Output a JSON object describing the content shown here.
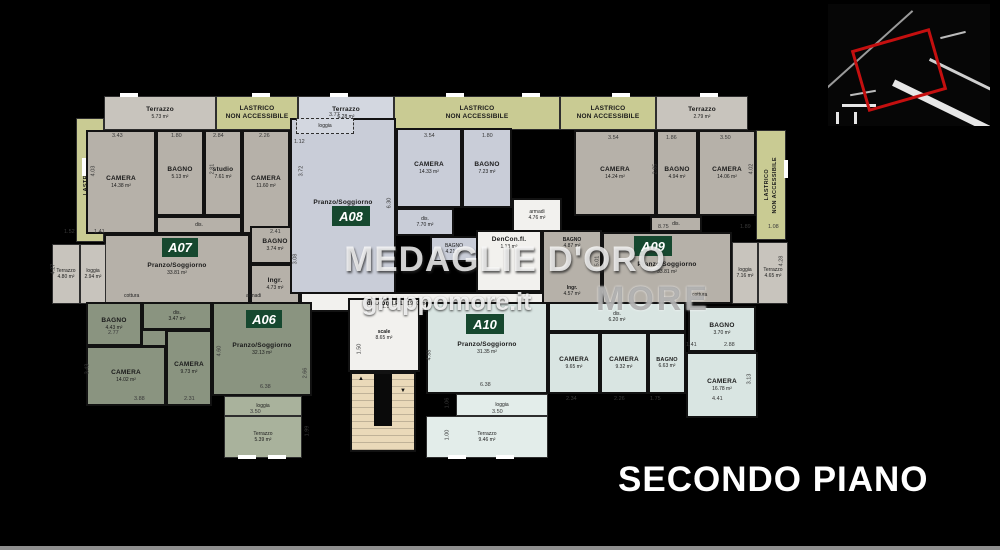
{
  "page": {
    "floor_title": "SECONDO PIANO"
  },
  "watermark": {
    "brand": "MEDAGLIE D'ORO",
    "site": "gruppomore.it",
    "logo": "MORE"
  },
  "legend": {
    "lastrico_line1": "LASTRICO",
    "lastrico_line2": "NON ACCESSIBILE"
  },
  "annotations": {
    "cottura": "cottura",
    "armadi": "armadi"
  },
  "common_areas": {
    "stairs": {
      "name": "scale",
      "area": "8.65 m²"
    },
    "landing": {
      "name": "dis.cond.P1",
      "area": "19.93 m²"
    },
    "wardrobe": {
      "name": "armadi",
      "area": "4.76 m²"
    },
    "den": {
      "name": "DenCon.fl.",
      "area": "1.13 m²"
    }
  },
  "apartments": {
    "a06": {
      "id": "A06",
      "rooms": {
        "bagno": {
          "name": "BAGNO",
          "area": "4.43 m²"
        },
        "dis": {
          "name": "dis.",
          "area": "3.47 m²"
        },
        "camera1": {
          "name": "CAMERA",
          "area": "14.02 m²"
        },
        "camera2": {
          "name": "CAMERA",
          "area": "9.73 m²"
        },
        "soggiorno": {
          "name": "Pranzo/Soggiorno",
          "area": "32.13 m²"
        },
        "loggia": {
          "name": "loggia",
          "area": "3.55 m²"
        },
        "terrazzo": {
          "name": "Terrazzo",
          "area": "5.39 m²"
        }
      }
    },
    "a07": {
      "id": "A07",
      "rooms": {
        "terrazzo_top": {
          "name": "Terrazzo",
          "area": "5.73 m²"
        },
        "camera1": {
          "name": "CAMERA",
          "area": "14.38 m²"
        },
        "bagno1": {
          "name": "BAGNO",
          "area": "5.13 m²"
        },
        "studio": {
          "name": "studio",
          "area": "7.61 m²"
        },
        "camera2": {
          "name": "CAMERA",
          "area": "11.60 m²"
        },
        "dis": {
          "name": "dis.",
          "area": "5.70 m²"
        },
        "soggiorno": {
          "name": "Pranzo/Soggiorno",
          "area": "33.81 m²"
        },
        "bagno2": {
          "name": "BAGNO",
          "area": "3.74 m²"
        },
        "ingresso": {
          "name": "Ingr.",
          "area": "4.73 m²"
        },
        "terrazzo": {
          "name": "Terrazzo",
          "area": "4.80 m²"
        },
        "loggia": {
          "name": "loggia",
          "area": "2.94 m²"
        }
      }
    },
    "a08": {
      "id": "A08",
      "rooms": {
        "terrazzo_top": {
          "name": "Terrazzo",
          "area": "6.28 m²"
        },
        "loggia": {
          "name": "loggia",
          "area": "4.90 m²"
        },
        "soggiorno": {
          "name": "Pranzo/Soggiorno",
          "area": "35.64 m²"
        },
        "camera": {
          "name": "CAMERA",
          "area": "14.33 m²"
        },
        "bagno1": {
          "name": "BAGNO",
          "area": "7.23 m²"
        },
        "dis": {
          "name": "dis.",
          "area": "7.70 m²"
        },
        "bagno2": {
          "name": "BAGNO",
          "area": "4.21 m²"
        }
      }
    },
    "a09": {
      "id": "A09",
      "rooms": {
        "terrazzo_top": {
          "name": "Terrazzo",
          "area": "2.79 m²"
        },
        "camera1": {
          "name": "CAMERA",
          "area": "14.24 m²"
        },
        "bagno1": {
          "name": "BAGNO",
          "area": "4.94 m²"
        },
        "camera2": {
          "name": "CAMERA",
          "area": "14.06 m²"
        },
        "dis": {
          "name": "dis.",
          "area": "2.43 m²"
        },
        "bagno2": {
          "name": "BAGNO",
          "area": "4.87 m²"
        },
        "ingresso": {
          "name": "Ingr.",
          "area": "4.57 m²"
        },
        "soggiorno": {
          "name": "Pranzo/Soggiorno",
          "area": "33.81 m²"
        },
        "loggia": {
          "name": "loggia",
          "area": "7.16 m²"
        },
        "terrazzo": {
          "name": "Terrazzo",
          "area": "4.65 m²"
        }
      }
    },
    "a10": {
      "id": "A10",
      "rooms": {
        "soggiorno": {
          "name": "Pranzo/Soggiorno",
          "area": "31.35 m²"
        },
        "dis": {
          "name": "dis.",
          "area": "6.20 m²"
        },
        "camera1": {
          "name": "CAMERA",
          "area": "9.65 m²"
        },
        "camera2": {
          "name": "CAMERA",
          "area": "9.32 m²"
        },
        "bagno1": {
          "name": "BAGNO",
          "area": "6.63 m²"
        },
        "bagno2": {
          "name": "BAGNO",
          "area": "3.70 m²"
        },
        "camera3": {
          "name": "CAMERA",
          "area": "16.78 m²"
        },
        "loggia": {
          "name": "loggia",
          "area": "3.57 m²"
        },
        "terrazzo": {
          "name": "Terrazzo",
          "area": "9.46 m²"
        }
      }
    }
  },
  "dims": [
    "3.43",
    "1.80",
    "2.84",
    "2.26",
    "4.03",
    "2.81",
    "1.12",
    "3.77",
    "3.72",
    "3.54",
    "1.80",
    "3.54",
    "1.86",
    "3.50",
    "2.85",
    "4.02",
    "6.30",
    "8.75",
    "1.89",
    "1.08",
    "5.01",
    "4.28",
    "1.52",
    "1.41",
    "4.27",
    "2.41",
    "1.53",
    "1.50",
    "2.77",
    "3.43",
    "3.88",
    "2.31",
    "4.60",
    "6.38",
    "2.66",
    "3.50",
    "4.88",
    "6.38",
    "2.34",
    "2.26",
    "1.75",
    "4.41",
    "3.13",
    "1.41",
    "2.88",
    "3.50",
    "1.06",
    "1.00",
    "3.08",
    "1.99"
  ]
}
